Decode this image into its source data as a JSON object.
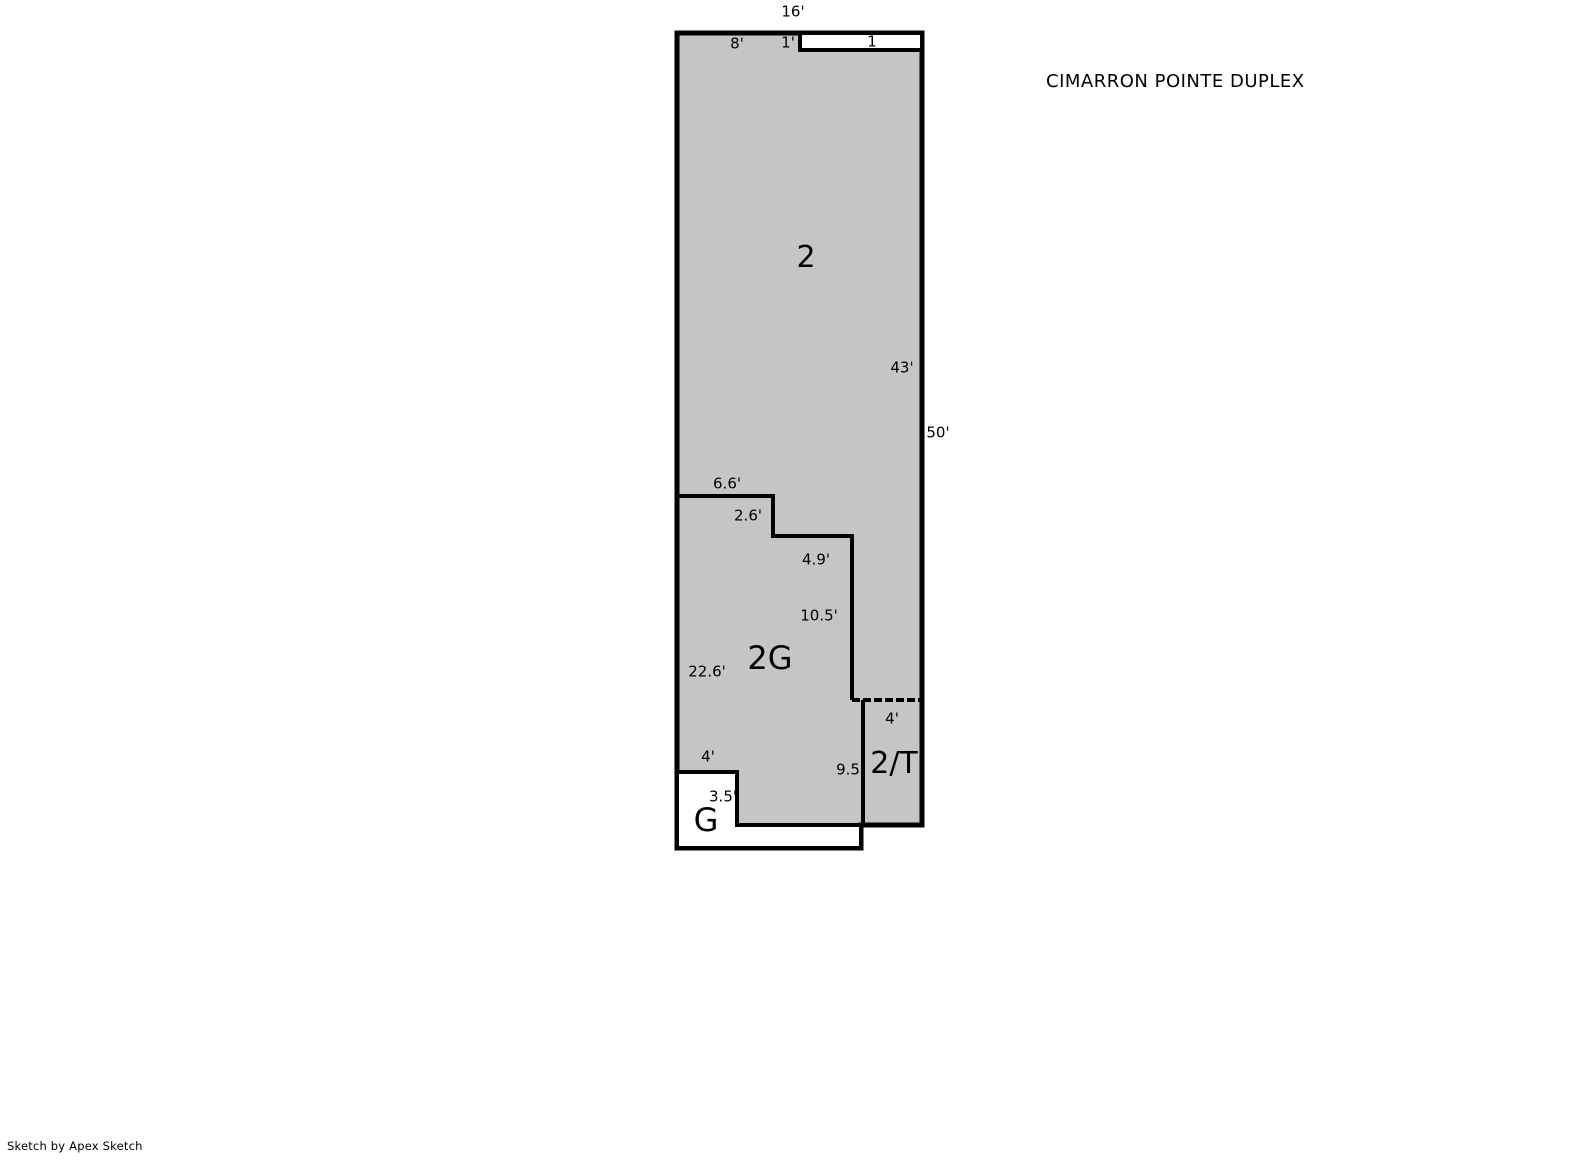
{
  "title": "CIMARRON POINTE DUPLEX",
  "footer": "Sketch by Apex Sketch",
  "colors": {
    "area_fill": "#c5c5c5",
    "outline": "#000000",
    "background": "#ffffff"
  },
  "regions": {
    "unit2": "2",
    "unit2g": "2G",
    "unit2t": "2/T",
    "garage": "G",
    "porch": "1"
  },
  "dimensions": {
    "top_width": "16'",
    "top_segment_left": "8'",
    "porch_depth": "1'",
    "right_wall_upper": "43'",
    "right_wall_total": "50'",
    "step1_horizontal": "6.6'",
    "step1_vertical": "2.6'",
    "step2_horizontal": "4.9'",
    "step2_vertical": "10.5'",
    "left_wall_2g": "22.6'",
    "terrace_width": "4'",
    "terrace_height": "9.5",
    "garage_width": "4'",
    "garage_height": "3.5'"
  }
}
